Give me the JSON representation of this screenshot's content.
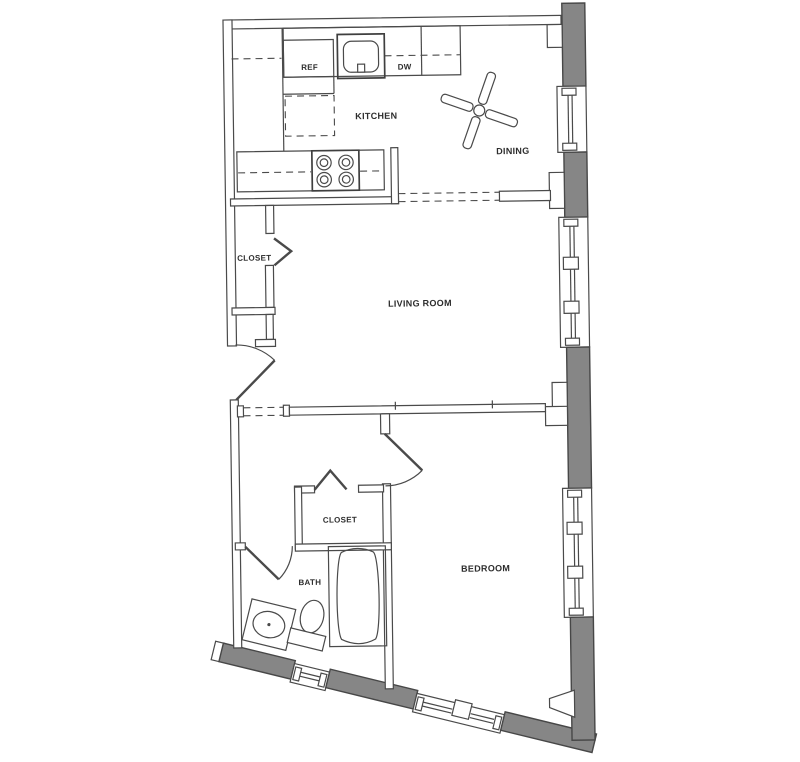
{
  "title": "One-bedroom apartment floor plan",
  "colors": {
    "background": "#ffffff",
    "wall_fill": "#868686",
    "line": "#4a4a4a",
    "label_text": "#2d2d2d"
  },
  "rooms": {
    "kitchen": {
      "label": "KITCHEN"
    },
    "dining": {
      "label": "DINING"
    },
    "living_room": {
      "label": "LIVING ROOM"
    },
    "entry_closet": {
      "label": "CLOSET"
    },
    "bedroom_closet": {
      "label": "CLOSET"
    },
    "bath": {
      "label": "BATH"
    },
    "bedroom": {
      "label": "BEDROOM"
    }
  },
  "appliances": {
    "refrigerator": {
      "label": "REF"
    },
    "dishwasher": {
      "label": "DW"
    }
  },
  "fixtures": [
    "ceiling-fan",
    "range-4-burner",
    "kitchen-sink",
    "kitchen-island",
    "bathtub",
    "toilet",
    "vanity-sink",
    "entry-door",
    "bedroom-door",
    "bath-door",
    "bifold-closet-doors",
    "exterior-windows"
  ]
}
